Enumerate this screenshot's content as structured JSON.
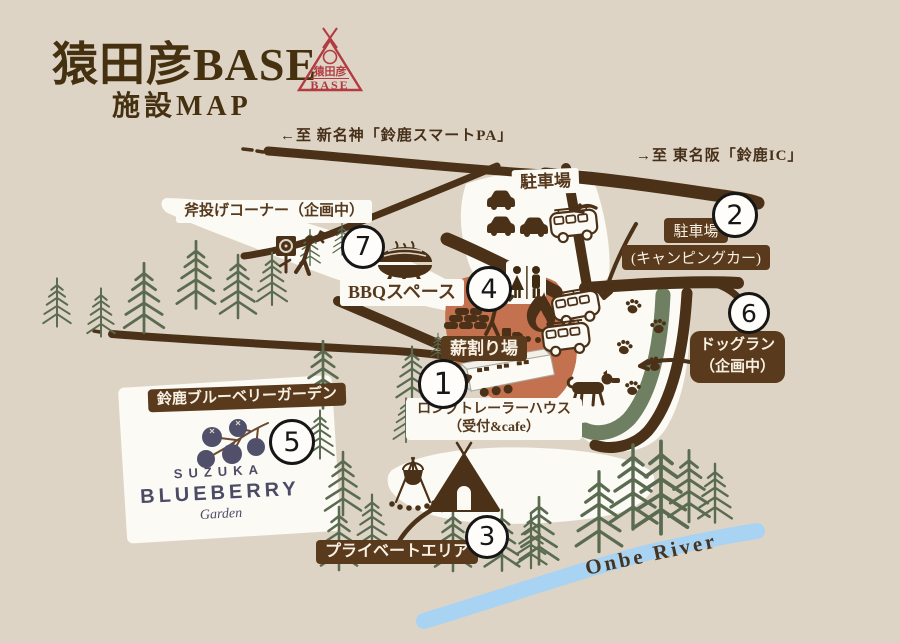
{
  "title": {
    "main": "猿田彦BASE",
    "subtitle": "施設MAP"
  },
  "logo": {
    "name": "猿田彦",
    "base": "BASE"
  },
  "directions": {
    "to_shinmeishin": "←至 新名神「鈴鹿スマートPA」",
    "to_higashimeihan": "→至 東名阪「鈴鹿IC」"
  },
  "areas": {
    "parking": "駐車場",
    "camper_parking_1": "駐車場",
    "camper_parking_2": "(キャンピングカー)",
    "axe_throwing": "斧投げコーナー（企画中）",
    "bbq": "BBQスペース",
    "firewood": "薪割り場",
    "trailer_1": "ロングトレーラーハウス",
    "trailer_2": "（受付&cafe）",
    "dog_run_1": "ドッグラン",
    "dog_run_2": "（企画中）",
    "blueberry_garden": "鈴鹿ブルーベリーガーデン",
    "private_area": "プライベートエリア"
  },
  "river": {
    "name": "Onbe River"
  },
  "blueberry_logo": {
    "line1": "SUZUKA",
    "line2": "BLUEBERRY",
    "line3": "Garden"
  },
  "markers": [
    "1",
    "2",
    "3",
    "4",
    "5",
    "6",
    "7"
  ],
  "icon_names": [
    "car-icon",
    "van-icon",
    "bbq-grill-icon",
    "restroom-icon",
    "axe-target-icon",
    "axe-thrower-icon",
    "woodpile-icon",
    "wood-chopper-icon",
    "campfire-icon",
    "trailer-icon",
    "camper-van-icon",
    "paw-print-icon",
    "dog-icon",
    "tent-icon",
    "tripod-pot-icon",
    "berry-cluster-icon",
    "pine-tree-icon"
  ],
  "colors": {
    "background": "#ddd4c5",
    "road_brown": "#4b3117",
    "label_dark_bg": "#5a3a1c",
    "label_cream": "#f7f1e4",
    "white_area": "#fcfaf4",
    "terracotta": "#c3714e",
    "dogrun_green": "#6e8061",
    "tree_green": "#5a6b52",
    "river_blue": "#a9d3f3",
    "title_brown": "#45300f",
    "logo_red": "#b23a40",
    "blueberry_navy": "#4c4b66"
  }
}
